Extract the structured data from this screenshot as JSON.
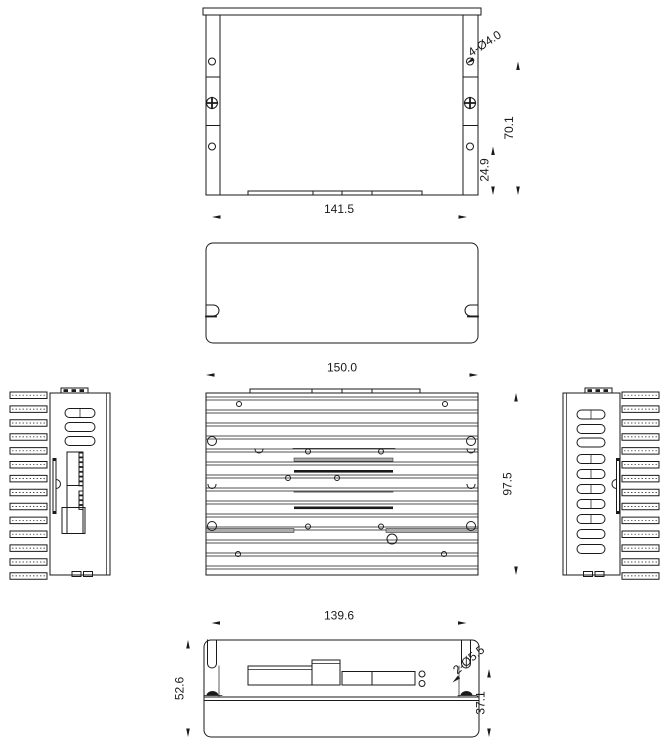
{
  "drawing": {
    "type": "orthographic-engineering-drawing",
    "line_color": "#1a1a1a",
    "background": "#ffffff",
    "views": {
      "top_view": {
        "dim_width": "141.5",
        "dim_hole_span": "70.1",
        "dim_hole_offset": "24.9",
        "callout_holes": "4-Ø4.0"
      },
      "front_view": {
        "dim_width": "150.0",
        "dim_height": "97.5"
      },
      "bottom_view": {
        "dim_slot_span": "139.6",
        "dim_height": "52.6",
        "dim_inner_height": "37.1",
        "callout_holes": "2-Ø5.5"
      }
    }
  }
}
